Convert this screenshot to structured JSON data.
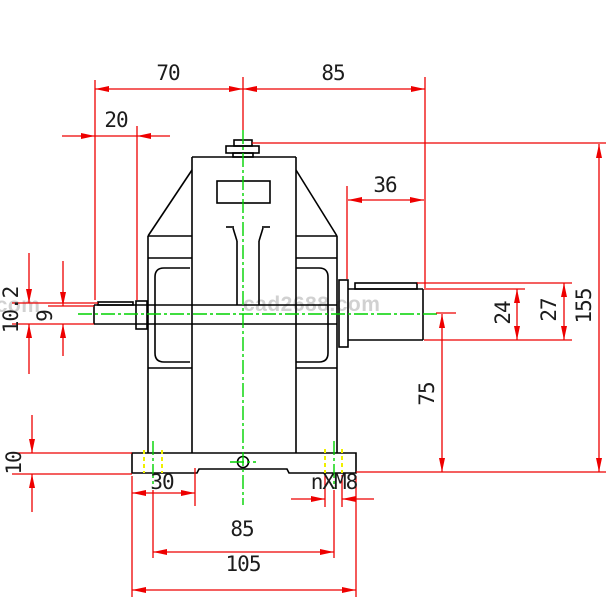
{
  "drawing": {
    "type": "cad-2d-front-view-gear-reducer",
    "watermark": "cad2688.com",
    "watermark_fragment": "cad2688.com",
    "colors": {
      "dimension": "#ee0000",
      "centerline": "#00d200",
      "hidden_line": "#f0f000",
      "outline": "#000000",
      "watermark": "#c9c9c9",
      "background": "#ffffff"
    },
    "dimensions": {
      "top_left_span": "70",
      "top_right_span": "85",
      "input_shaft_extension": "20",
      "output_shaft_extension": "36",
      "input_key_height": "10.2",
      "input_shaft_diameter": "9",
      "output_shaft_diameter": "24",
      "output_key_height": "27",
      "overall_height": "155",
      "shaft_center_height": "75",
      "base_plate_thickness": "10",
      "foot_width": "30",
      "mounting_hole_callout": "nXM8",
      "hole_spacing": "85",
      "base_width": "105"
    }
  }
}
